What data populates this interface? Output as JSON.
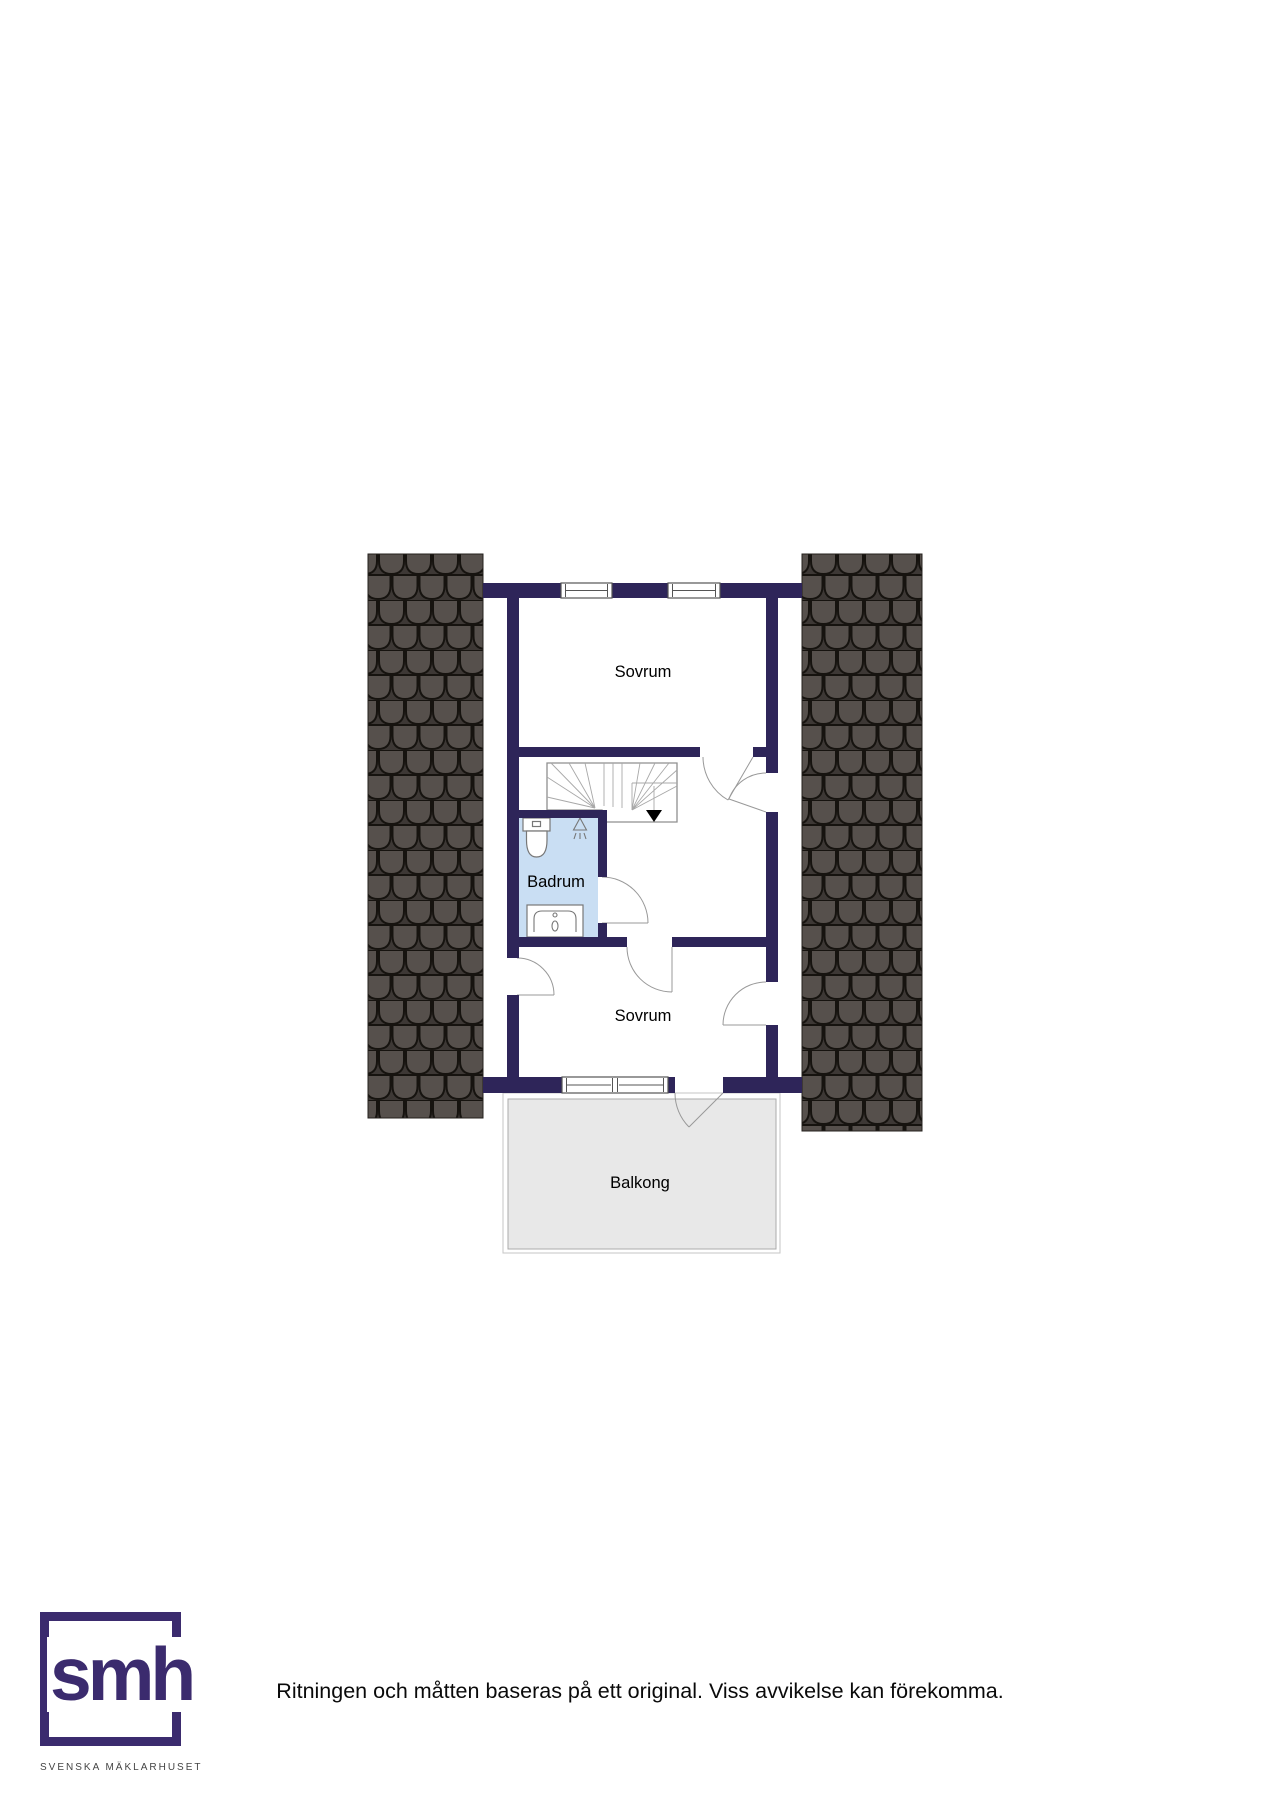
{
  "plan": {
    "rooms": [
      {
        "label": "Sovrum"
      },
      {
        "label": "Badrum"
      },
      {
        "label": "Sovrum"
      },
      {
        "label": "Balkong"
      }
    ]
  },
  "footer": {
    "brand": "smh",
    "company": "SVENSKA MÄKLARHUSET",
    "disclaimer": "Ritningen och måtten baseras på ett original. Viss avvikelse kan förekomma."
  },
  "colors": {
    "wall": "#2e2559",
    "window_frame": "#555555",
    "bathroom": "#c9def3",
    "balcony": "#e8e8e8",
    "roofbase": "#3d3835",
    "roofshingle": "#56504c",
    "roofline": "#16130f",
    "logo": "#3b2b6e",
    "line": "#999999",
    "text": "#000000"
  }
}
